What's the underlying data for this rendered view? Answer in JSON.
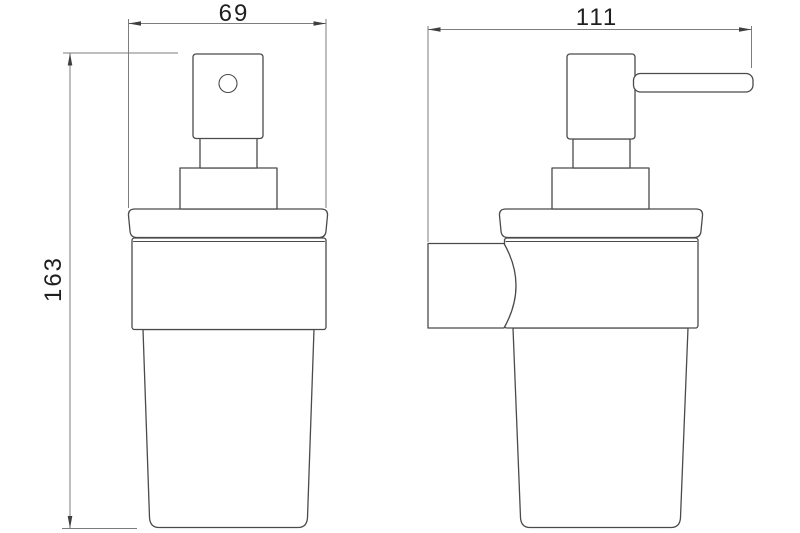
{
  "drawing": {
    "description": "Technical line drawing of a wall-mounted soap dispenser, front view and side view",
    "colors": {
      "background": "#ffffff",
      "outline": "#4a4a4a",
      "dimension_lines": "#7d7d7d",
      "labels": "#1f1f1f"
    },
    "labels": {
      "front_width": "69",
      "side_width": "111",
      "overall_height": "163"
    }
  }
}
